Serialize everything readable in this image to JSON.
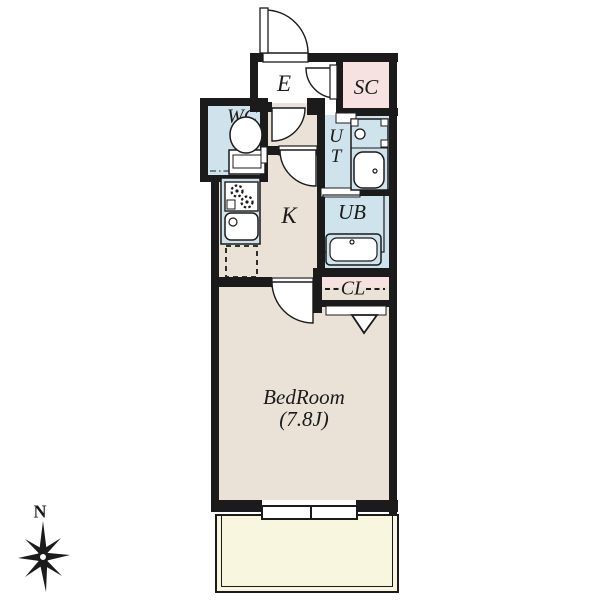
{
  "plan_title": "1K apartment floor plan",
  "colors": {
    "wall": "#1b1b1b",
    "floor_beige": "#eae2d6",
    "wet_area_blue": "#cfe3ec",
    "closet_pink": "#f6e3e1",
    "balcony_yellow": "#f8f6df",
    "background": "#ffffff"
  },
  "rooms": {
    "entrance": {
      "label": "E"
    },
    "shoe_closet": {
      "label": "SC"
    },
    "toilet": {
      "label": "WC"
    },
    "utility": {
      "line1": "U",
      "line2": "T"
    },
    "unit_bath": {
      "label": "UB"
    },
    "kitchen": {
      "label": "K"
    },
    "closet": {
      "label": "CL"
    },
    "bedroom": {
      "label": "BedRoom",
      "size": "(7.8J)"
    },
    "balcony": {
      "label": "Balcony"
    }
  },
  "compass": {
    "north_label": "N"
  }
}
